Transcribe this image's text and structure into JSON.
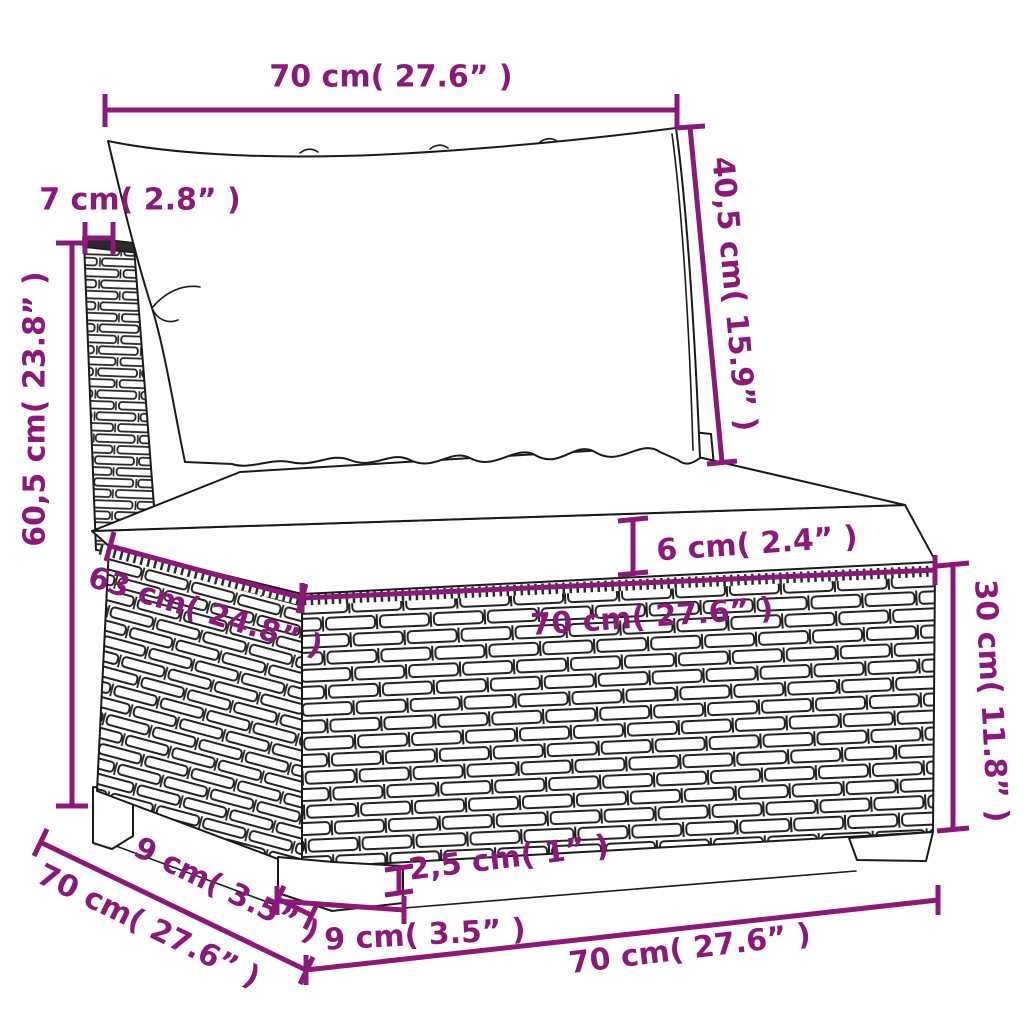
{
  "colors": {
    "dimension_accent": "#8C1879",
    "line_art": "#1a1a1a",
    "background": "#ffffff"
  },
  "labels": {
    "top_width": "70 cm( 27.6”  )",
    "backrest_thickness": "7 cm( 2.8”  )",
    "backrest_height": "40,5 cm( 15.9”  )",
    "total_height": "60,5 cm( 23.8”  )",
    "cushion_thickness": "6 cm( 2.4”  )",
    "seat_depth": "63 cm( 24.8”  )",
    "seat_width": "70 cm( 27.6”  )",
    "base_height": "30 cm( 11.8”  )",
    "leg_depth": "9 cm( 3.5”  )",
    "side_depth": "70 cm( 27.6”  )",
    "leg_height": "2,5 cm( 1”  )",
    "leg_width": "9 cm( 3.5”  )",
    "front_width": "70 cm( 27.6”  )"
  }
}
